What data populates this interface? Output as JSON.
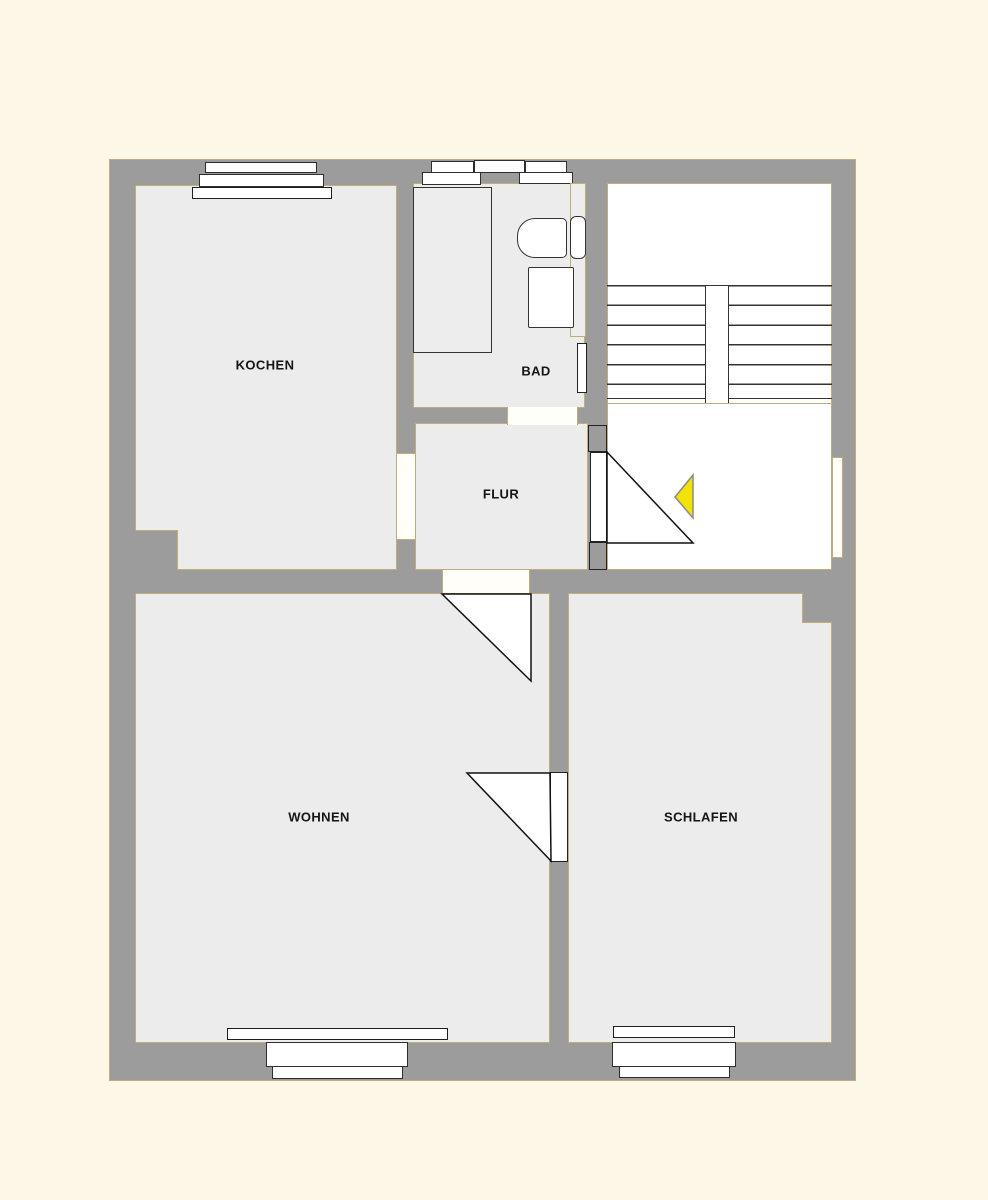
{
  "plan": {
    "rooms": {
      "kochen": {
        "label": "KOCHEN"
      },
      "bad": {
        "label": "BAD"
      },
      "flur": {
        "label": "FLUR"
      },
      "wohnen": {
        "label": "WOHNEN"
      },
      "schlafen": {
        "label": "SCHLAFEN"
      }
    },
    "markers": {
      "entrance_arrow": {
        "shape": "left-pointing-triangle",
        "color": "#F2E205"
      }
    }
  },
  "colors": {
    "bg": "#FCF7E7",
    "wall": "#9C9C9C",
    "floor": "#ECECEC",
    "stair": "#FFFFFF",
    "tan": "#C2AC7C",
    "ink": "#1C1C1C",
    "arrow": "#F2E205"
  }
}
